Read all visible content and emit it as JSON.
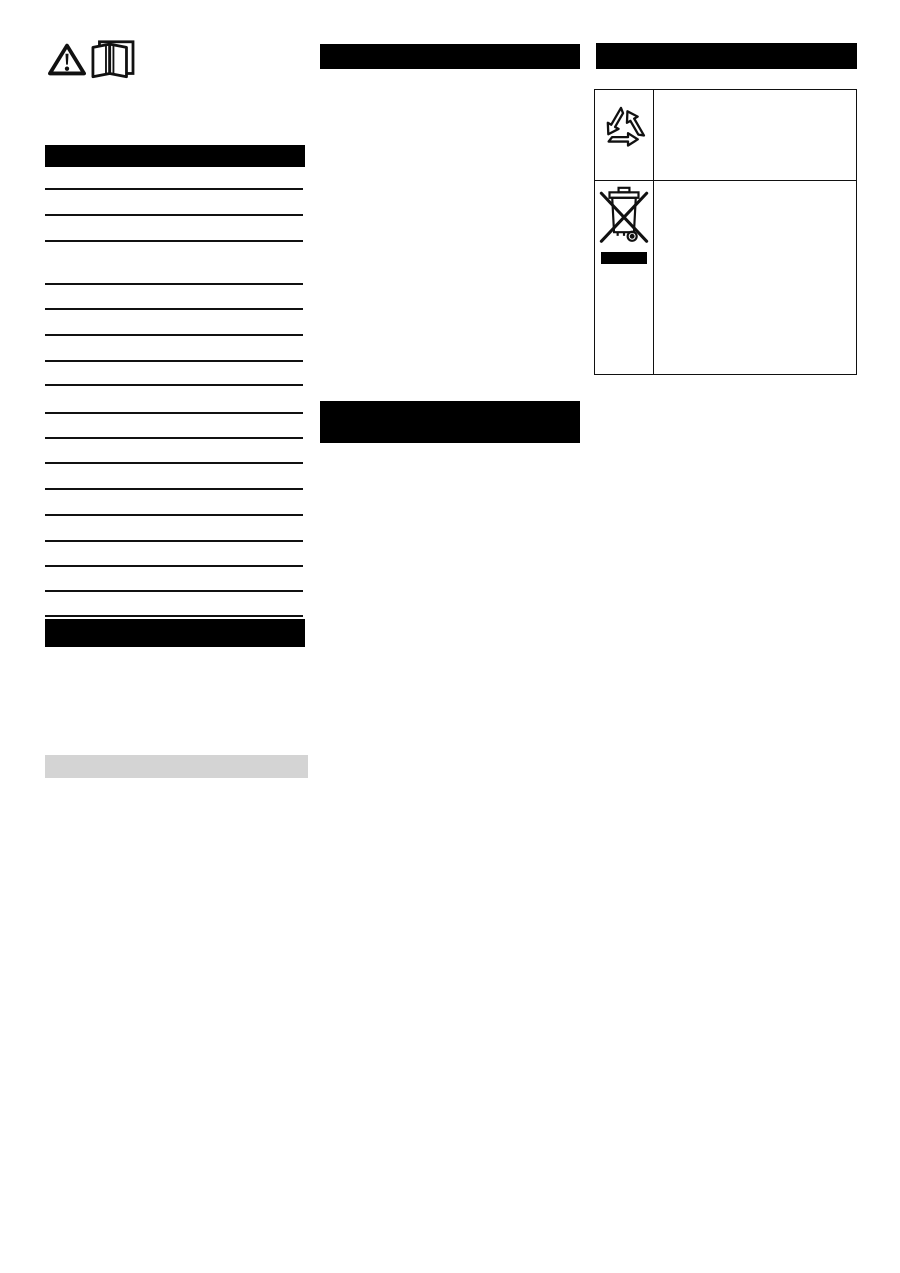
{
  "document": {
    "kind": "operating-manual page with redacted headings",
    "page_background": "#ffffff"
  },
  "colors": {
    "redacted_bar": "#000000",
    "gray_highlight": "#d4d4d4",
    "rule_line": "#111111",
    "icon_stroke": "#111111"
  },
  "note_icons": {
    "warning": "warning-triangle",
    "manual": "read-operating-manual-open-book"
  },
  "left_column": {
    "section_bar_top": "redacted-section-heading",
    "toc_rule_offsets_y": [
      188,
      214,
      240,
      283,
      308,
      334,
      360,
      384,
      412,
      437,
      462,
      488,
      514,
      540,
      565,
      590,
      615
    ],
    "section_bar_bottom": "redacted-section-heading",
    "gray_bar": "gray-highlight-row"
  },
  "middle_column": {
    "section_bar_top": "redacted-section-heading",
    "section_bar_double": "redacted-two-line-section-heading"
  },
  "right_column": {
    "section_bar_top": "redacted-section-heading",
    "symbol_table": {
      "rows": [
        {
          "icon": "recycling-arrows",
          "text": ""
        },
        {
          "icon": "weee-crossed-out-wheelie-bin",
          "badge": "black-substance-bar",
          "text": ""
        }
      ]
    }
  }
}
